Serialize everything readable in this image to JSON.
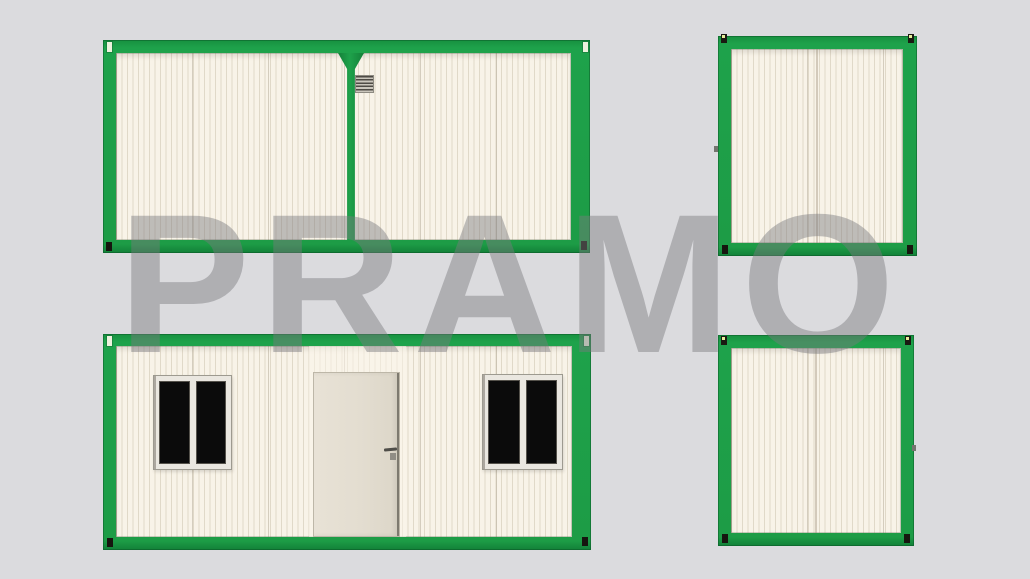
{
  "page": {
    "type": "product-render",
    "description": "Four elevation views of a green-framed portable container house with a gray watermark overlay"
  },
  "watermark": {
    "text": "PRAMO"
  },
  "colors": {
    "background": "#dbdbde",
    "frame_green": "#1ea24b",
    "frame_green_dark": "#0e7c33",
    "wall_cream": "#f8f3e8",
    "wall_stripe": "#e2dac6",
    "window_glass": "#0b0b0b",
    "window_frame": "#eae7e0",
    "door_panel": "#e3ddd0",
    "vent_gray": "#cac6bc",
    "watermark_gray": "#7a7a7f"
  },
  "views": [
    {
      "id": "rear-elevation",
      "position": "top-left",
      "features": [
        "center-divider",
        "vent-grille"
      ]
    },
    {
      "id": "end-elevation-a",
      "position": "top-right",
      "features": [
        "center-seam"
      ]
    },
    {
      "id": "front-elevation",
      "position": "bottom-left",
      "features": [
        "door",
        "door-handle",
        "window-left",
        "window-right"
      ]
    },
    {
      "id": "end-elevation-b",
      "position": "bottom-right",
      "features": [
        "center-seam"
      ]
    }
  ],
  "counts": {
    "windows": 2,
    "doors": 1,
    "vents": 1,
    "views": 4
  }
}
